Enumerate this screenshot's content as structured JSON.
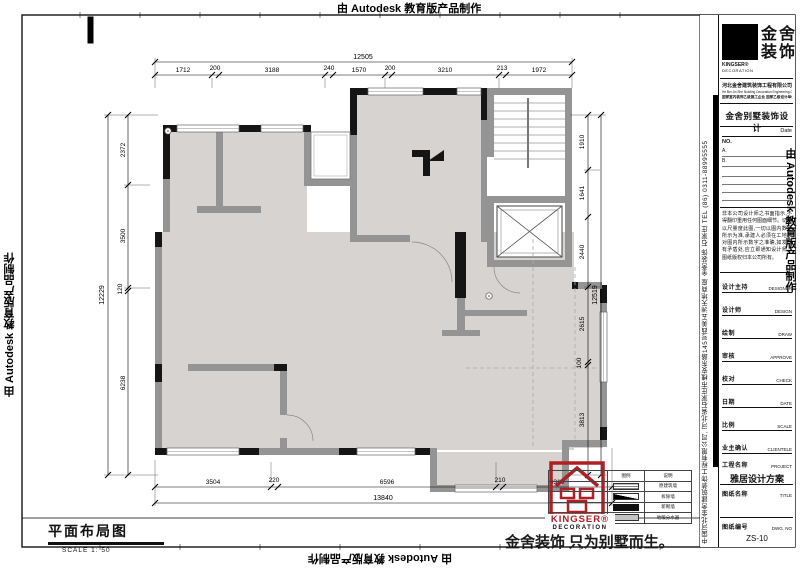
{
  "watermarks": {
    "text": "由 Autodesk 教育版产品制作"
  },
  "title_block": {
    "brand_cn1": "金舍",
    "brand_cn2": "装饰",
    "brand_en": "KINGSER®",
    "brand_en2": "DECORATION",
    "company": "河北金舍建筑装饰工程有限公司",
    "company_en": "He Bei Jin She Building Decoration Engineering Co., Ltd.",
    "qualification": "国家室内装饰乙级施工企业 国家乙级设计单位",
    "design_title": "金舍别墅装饰设计",
    "date_label": "Date",
    "no_label": "NO.",
    "no_rows": [
      "A.",
      "B."
    ],
    "disclaimer": "非本公司设计师之书面指示,不得翻印重用任何图面细节。切勿以尺量度此图,一切以图内数字所示为准,承建人必须在工地核对图内所示数字之准确,如发现有矛盾处,应立即通知设计师。图纸版权归本公司所有。",
    "fields": [
      {
        "label": "设计主持",
        "en": "DESIGNER"
      },
      {
        "label": "设计师",
        "en": "DESIGN"
      },
      {
        "label": "绘制",
        "en": "DRAW"
      },
      {
        "label": "审核",
        "en": "APPROVE"
      },
      {
        "label": "校对",
        "en": "CHECK"
      },
      {
        "label": "日期",
        "en": "DATE"
      },
      {
        "label": "比例",
        "en": "SCALE"
      },
      {
        "label": "业主确认",
        "en": "CLIENTELE"
      },
      {
        "label": "工程名称",
        "en": "PROJECT"
      },
      {
        "label": "图纸名称",
        "en": "TITLE"
      },
      {
        "label": "图纸编号",
        "en": "DWG. NO"
      }
    ],
    "project_value": "雅居设计方案",
    "dwg_no": "ZS-10",
    "address_vertical": "中国河北金舍建筑装饰工程有限公司, 河北省石家庄市槐安东路145号西美五洲天地商座 金舍装饰  石家庄  TEL (86) 0311-88995555"
  },
  "plan": {
    "title": "平面布局图",
    "scale": "SCALE 1: 50",
    "slogan": "金舍装饰 只为别墅而生。",
    "logo_line1": "KINGSER®",
    "logo_line2": "DECORATION",
    "legend": {
      "headers": [
        "图例",
        "说明"
      ],
      "rows": [
        {
          "label": "原建筑墙"
        },
        {
          "label": "拆除墙"
        },
        {
          "label": "新砌墙"
        },
        {
          "label": "地暖分水器"
        }
      ]
    }
  },
  "dimensions": {
    "top": {
      "total": "12505",
      "segments": [
        "1712",
        "200",
        "3188",
        "240",
        "1570",
        "200",
        "3210",
        "213",
        "1972"
      ]
    },
    "bottom": {
      "total": "13840",
      "segments": [
        "3504",
        "220",
        "6596",
        "210",
        "3310"
      ]
    },
    "left": {
      "total": "12229",
      "segments": [
        "2372",
        "3500",
        "120",
        "6238"
      ]
    },
    "right": {
      "total": "12519",
      "segments": [
        "1910",
        "1641",
        "2440",
        "2615",
        "100",
        "3813"
      ]
    }
  }
}
